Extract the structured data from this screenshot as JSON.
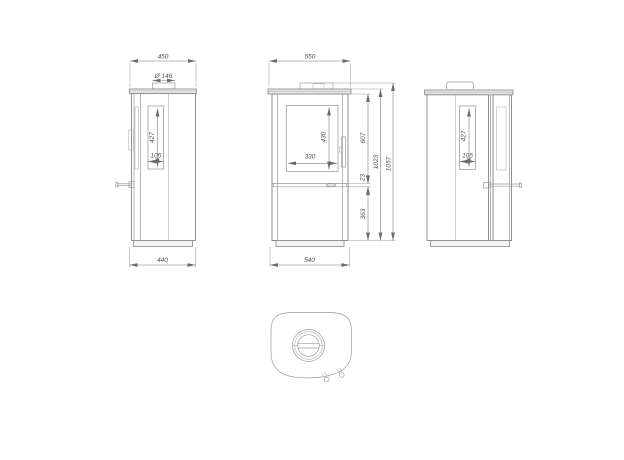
{
  "drawing": {
    "type": "technical-dimension-drawing",
    "subject": "free-standing wood stove, three orthographic views and top view",
    "line_color": "#8a8a8a",
    "dim_color": "#7d7d7d",
    "text_color": "#4f4f4f",
    "background": "#ffffff"
  },
  "dims": {
    "left": {
      "top_width": "450",
      "flue_diameter": "Ø 146",
      "glass_height": "427",
      "glass_width": "105",
      "bottom_width": "440"
    },
    "front": {
      "top_width": "550",
      "glass_height": "430",
      "glass_width": "330",
      "upper_height": "607",
      "rail_height": "23",
      "lower_height": "363",
      "body_height": "1023",
      "total_height": "1057",
      "bottom_width": "540"
    },
    "right": {
      "glass_height": "427",
      "glass_width": "105"
    }
  }
}
